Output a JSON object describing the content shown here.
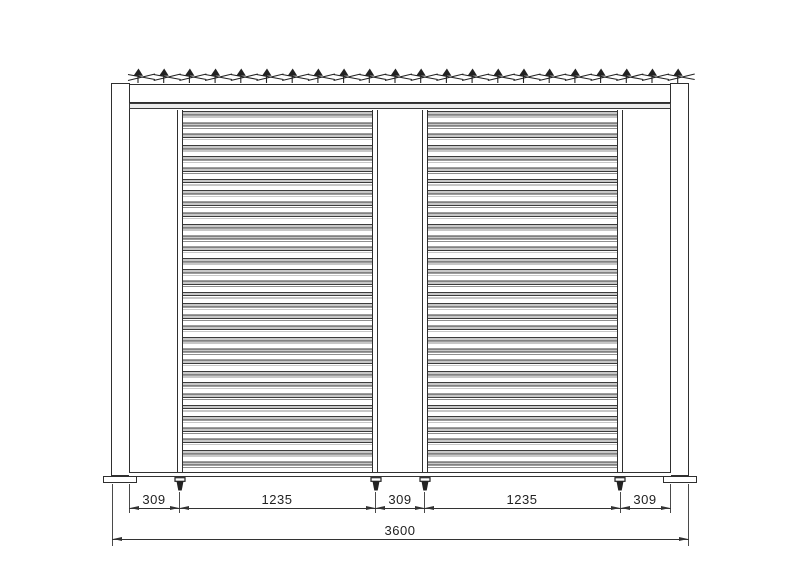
{
  "dimensions": {
    "row1": [
      "309",
      "1235",
      "309",
      "1235",
      "309"
    ],
    "total": "3600"
  },
  "structure": {
    "roof_blade_count": 22,
    "panel_count": 2,
    "leveling_feet_count": 4
  },
  "colors": {
    "line": "#2f2f2f",
    "louver_fill": "#c8c8c8",
    "background": "#ffffff"
  }
}
